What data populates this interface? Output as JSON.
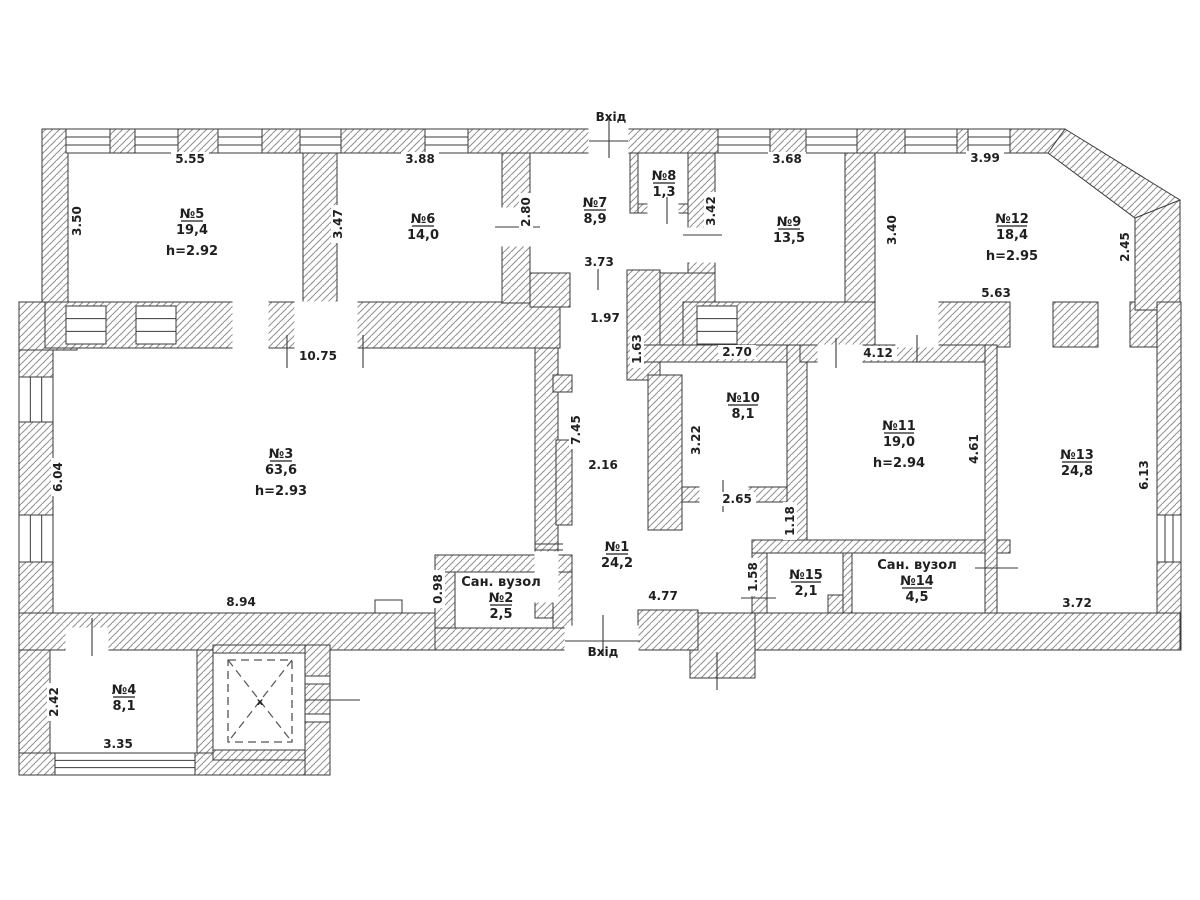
{
  "plan": {
    "colors": {
      "background": "#ffffff",
      "wall_stroke": "#3a3a3a",
      "hatch_line": "#8f8f8f",
      "text": "#1f1f1f",
      "dash": "#555555"
    },
    "entrance_labels": [
      {
        "label": "Вхід",
        "x": 611,
        "y": 121
      },
      {
        "label": "Вхід",
        "x": 603,
        "y": 656
      }
    ],
    "rooms": [
      {
        "name": "№5",
        "area": "19,4",
        "height": "h=2.92",
        "x": 192,
        "y": 218
      },
      {
        "name": "№6",
        "area": "14,0",
        "x": 423,
        "y": 223
      },
      {
        "name": "№7",
        "area": "8,9",
        "x": 595,
        "y": 207
      },
      {
        "name": "№8",
        "area": "1,3",
        "x": 664,
        "y": 180
      },
      {
        "name": "№9",
        "area": "13,5",
        "x": 789,
        "y": 226
      },
      {
        "name": "№12",
        "area": "18,4",
        "height": "h=2.95",
        "x": 1012,
        "y": 223
      },
      {
        "name": "№3",
        "area": "63,6",
        "height": "h=2.93",
        "x": 281,
        "y": 458
      },
      {
        "name": "№10",
        "area": "8,1",
        "x": 743,
        "y": 402
      },
      {
        "name": "№11",
        "area": "19,0",
        "height": "h=2.94",
        "x": 899,
        "y": 430
      },
      {
        "name": "№13",
        "area": "24,8",
        "x": 1077,
        "y": 459
      },
      {
        "name": "№1",
        "area": "24,2",
        "x": 617,
        "y": 551
      },
      {
        "prefix": "Сан. вузол",
        "name": "№2",
        "area": "2,5",
        "x": 501,
        "y": 602
      },
      {
        "prefix": "Сан. вузол",
        "name": "№14",
        "area": "4,5",
        "x": 917,
        "y": 585
      },
      {
        "name": "№15",
        "area": "2,1",
        "x": 806,
        "y": 579
      },
      {
        "name": "№4",
        "area": "8,1",
        "x": 124,
        "y": 694
      }
    ],
    "dimensions": [
      {
        "t": "5.55",
        "x": 190,
        "y": 163,
        "v": 0
      },
      {
        "t": "3.88",
        "x": 420,
        "y": 163,
        "v": 0
      },
      {
        "t": "3.68",
        "x": 787,
        "y": 163,
        "v": 0
      },
      {
        "t": "3.99",
        "x": 985,
        "y": 162,
        "v": 0
      },
      {
        "t": "3.50",
        "x": 81,
        "y": 221,
        "v": 1
      },
      {
        "t": "3.47",
        "x": 342,
        "y": 224,
        "v": 1
      },
      {
        "t": "2.80",
        "x": 530,
        "y": 212,
        "v": 1
      },
      {
        "t": "3.42",
        "x": 715,
        "y": 211,
        "v": 1
      },
      {
        "t": "3.40",
        "x": 896,
        "y": 230,
        "v": 1
      },
      {
        "t": "2.45",
        "x": 1129,
        "y": 247,
        "v": 1
      },
      {
        "t": "3.73",
        "x": 599,
        "y": 266,
        "v": 0
      },
      {
        "t": "1.97",
        "x": 605,
        "y": 322,
        "v": 0
      },
      {
        "t": "1.63",
        "x": 641,
        "y": 349,
        "v": 1
      },
      {
        "t": "10.75",
        "x": 318,
        "y": 360,
        "v": 0
      },
      {
        "t": "5.63",
        "x": 996,
        "y": 297,
        "v": 0
      },
      {
        "t": "2.70",
        "x": 737,
        "y": 356,
        "v": 0
      },
      {
        "t": "4.12",
        "x": 878,
        "y": 357,
        "v": 0
      },
      {
        "t": "6.04",
        "x": 62,
        "y": 477,
        "v": 1
      },
      {
        "t": "7.45",
        "x": 580,
        "y": 430,
        "v": 1
      },
      {
        "t": "2.16",
        "x": 603,
        "y": 469,
        "v": 0
      },
      {
        "t": "3.22",
        "x": 700,
        "y": 440,
        "v": 1
      },
      {
        "t": "4.61",
        "x": 978,
        "y": 449,
        "v": 1
      },
      {
        "t": "6.13",
        "x": 1148,
        "y": 475,
        "v": 1
      },
      {
        "t": "2.65",
        "x": 737,
        "y": 503,
        "v": 0
      },
      {
        "t": "1.18",
        "x": 794,
        "y": 521,
        "v": 1
      },
      {
        "t": "1.58",
        "x": 757,
        "y": 577,
        "v": 1
      },
      {
        "t": "0.98",
        "x": 442,
        "y": 589,
        "v": 1
      },
      {
        "t": "8.94",
        "x": 241,
        "y": 606,
        "v": 0
      },
      {
        "t": "4.77",
        "x": 663,
        "y": 600,
        "v": 0
      },
      {
        "t": "3.72",
        "x": 1077,
        "y": 607,
        "v": 0
      },
      {
        "t": "2.42",
        "x": 58,
        "y": 702,
        "v": 1
      },
      {
        "t": "3.35",
        "x": 118,
        "y": 748,
        "v": 0
      }
    ],
    "shaft": {
      "x_mark": "x",
      "x": 260,
      "y": 705
    },
    "geometry": {
      "walls": [
        [
          45,
          129,
          1020,
          24
        ],
        [
          42,
          129,
          26,
          175
        ],
        [
          19,
          302,
          58,
          48
        ],
        [
          19,
          350,
          34,
          300
        ],
        [
          45,
          302,
          515,
          46
        ],
        [
          303,
          153,
          34,
          150
        ],
        [
          502,
          153,
          28,
          150
        ],
        [
          630,
          153,
          8,
          60
        ],
        [
          638,
          204,
          50,
          9
        ],
        [
          688,
          153,
          27,
          150
        ],
        [
          630,
          273,
          85,
          77
        ],
        [
          845,
          153,
          30,
          150
        ],
        [
          683,
          302,
          192,
          46
        ],
        [
          938,
          302,
          72,
          45
        ],
        [
          1053,
          302,
          45,
          45
        ],
        [
          1130,
          302,
          27,
          45
        ],
        [
          1135,
          200,
          45,
          110
        ],
        [
          1157,
          302,
          24,
          348
        ],
        [
          535,
          348,
          23,
          270
        ],
        [
          553,
          375,
          19,
          17
        ],
        [
          556,
          440,
          16,
          85
        ],
        [
          530,
          273,
          40,
          34
        ],
        [
          627,
          270,
          33,
          110
        ],
        [
          648,
          375,
          34,
          155
        ],
        [
          643,
          345,
          157,
          17
        ],
        [
          682,
          487,
          125,
          15
        ],
        [
          787,
          345,
          20,
          208
        ],
        [
          800,
          345,
          185,
          17
        ],
        [
          752,
          540,
          258,
          13
        ],
        [
          752,
          553,
          15,
          60
        ],
        [
          843,
          553,
          9,
          60
        ],
        [
          828,
          595,
          15,
          18
        ],
        [
          985,
          345,
          12,
          268
        ],
        [
          755,
          613,
          425,
          37
        ],
        [
          690,
          613,
          65,
          65
        ],
        [
          638,
          610,
          60,
          40
        ],
        [
          435,
          628,
          130,
          22
        ],
        [
          435,
          555,
          20,
          73
        ],
        [
          435,
          555,
          137,
          17
        ],
        [
          553,
          572,
          19,
          56
        ],
        [
          19,
          613,
          416,
          37
        ],
        [
          19,
          650,
          31,
          125
        ],
        [
          19,
          753,
          311,
          22
        ],
        [
          305,
          645,
          25,
          130
        ],
        [
          197,
          650,
          16,
          103
        ],
        [
          213,
          645,
          92,
          8
        ],
        [
          213,
          750,
          92,
          10
        ]
      ],
      "diagonal": "1065,129 1180,200 1135,218 1048,153",
      "gaps": [
        [
          589,
          126,
          39,
          30
        ],
        [
          233,
          302,
          35,
          46
        ],
        [
          295,
          302,
          62,
          46
        ],
        [
          502,
          208,
          28,
          38
        ],
        [
          688,
          228,
          27,
          34
        ],
        [
          896,
          302,
          42,
          45
        ],
        [
          818,
          345,
          44,
          17
        ],
        [
          700,
          487,
          48,
          15
        ],
        [
          648,
          204,
          30,
          9
        ],
        [
          535,
          552,
          23,
          50
        ],
        [
          66,
          628,
          42,
          22
        ],
        [
          565,
          626,
          73,
          26
        ]
      ],
      "windows_h": [
        [
          66,
          129,
          44,
          24
        ],
        [
          135,
          129,
          43,
          24
        ],
        [
          218,
          129,
          44,
          24
        ],
        [
          300,
          129,
          41,
          24
        ],
        [
          425,
          129,
          43,
          24
        ],
        [
          718,
          129,
          52,
          24
        ],
        [
          806,
          129,
          51,
          24
        ],
        [
          905,
          129,
          52,
          24
        ],
        [
          968,
          129,
          42,
          24
        ],
        [
          55,
          753,
          140,
          22
        ],
        [
          66,
          306,
          40,
          38
        ],
        [
          136,
          306,
          40,
          38
        ],
        [
          697,
          306,
          40,
          38
        ]
      ],
      "windows_v": [
        [
          19,
          377,
          34,
          45
        ],
        [
          19,
          515,
          34,
          47
        ],
        [
          1157,
          515,
          24,
          47
        ]
      ],
      "small_rects": [
        [
          375,
          600,
          27,
          13
        ],
        [
          305,
          676,
          25,
          8
        ],
        [
          305,
          714,
          25,
          8
        ]
      ],
      "ticks_v": [
        [
          609,
          118,
          158
        ],
        [
          287,
          335,
          368
        ],
        [
          363,
          335,
          368
        ],
        [
          836,
          338,
          368
        ],
        [
          917,
          335,
          362
        ],
        [
          723,
          480,
          512
        ],
        [
          667,
          197,
          224
        ],
        [
          92,
          618,
          656
        ],
        [
          603,
          615,
          655
        ],
        [
          717,
          652,
          690
        ],
        [
          598,
          268,
          290
        ]
      ],
      "ticks_h": [
        [
          495,
          540,
          227
        ],
        [
          683,
          722,
          235
        ],
        [
          975,
          1018,
          568
        ],
        [
          741,
          776,
          598
        ],
        [
          305,
          360,
          700
        ],
        [
          535,
          563,
          544
        ],
        [
          535,
          563,
          550
        ],
        [
          565,
          640,
          641
        ],
        [
          589,
          628,
          141
        ]
      ],
      "shaft_outer": [
        213,
        653,
        92,
        97
      ],
      "shaft_dashed": [
        228,
        660,
        64,
        82
      ]
    }
  }
}
